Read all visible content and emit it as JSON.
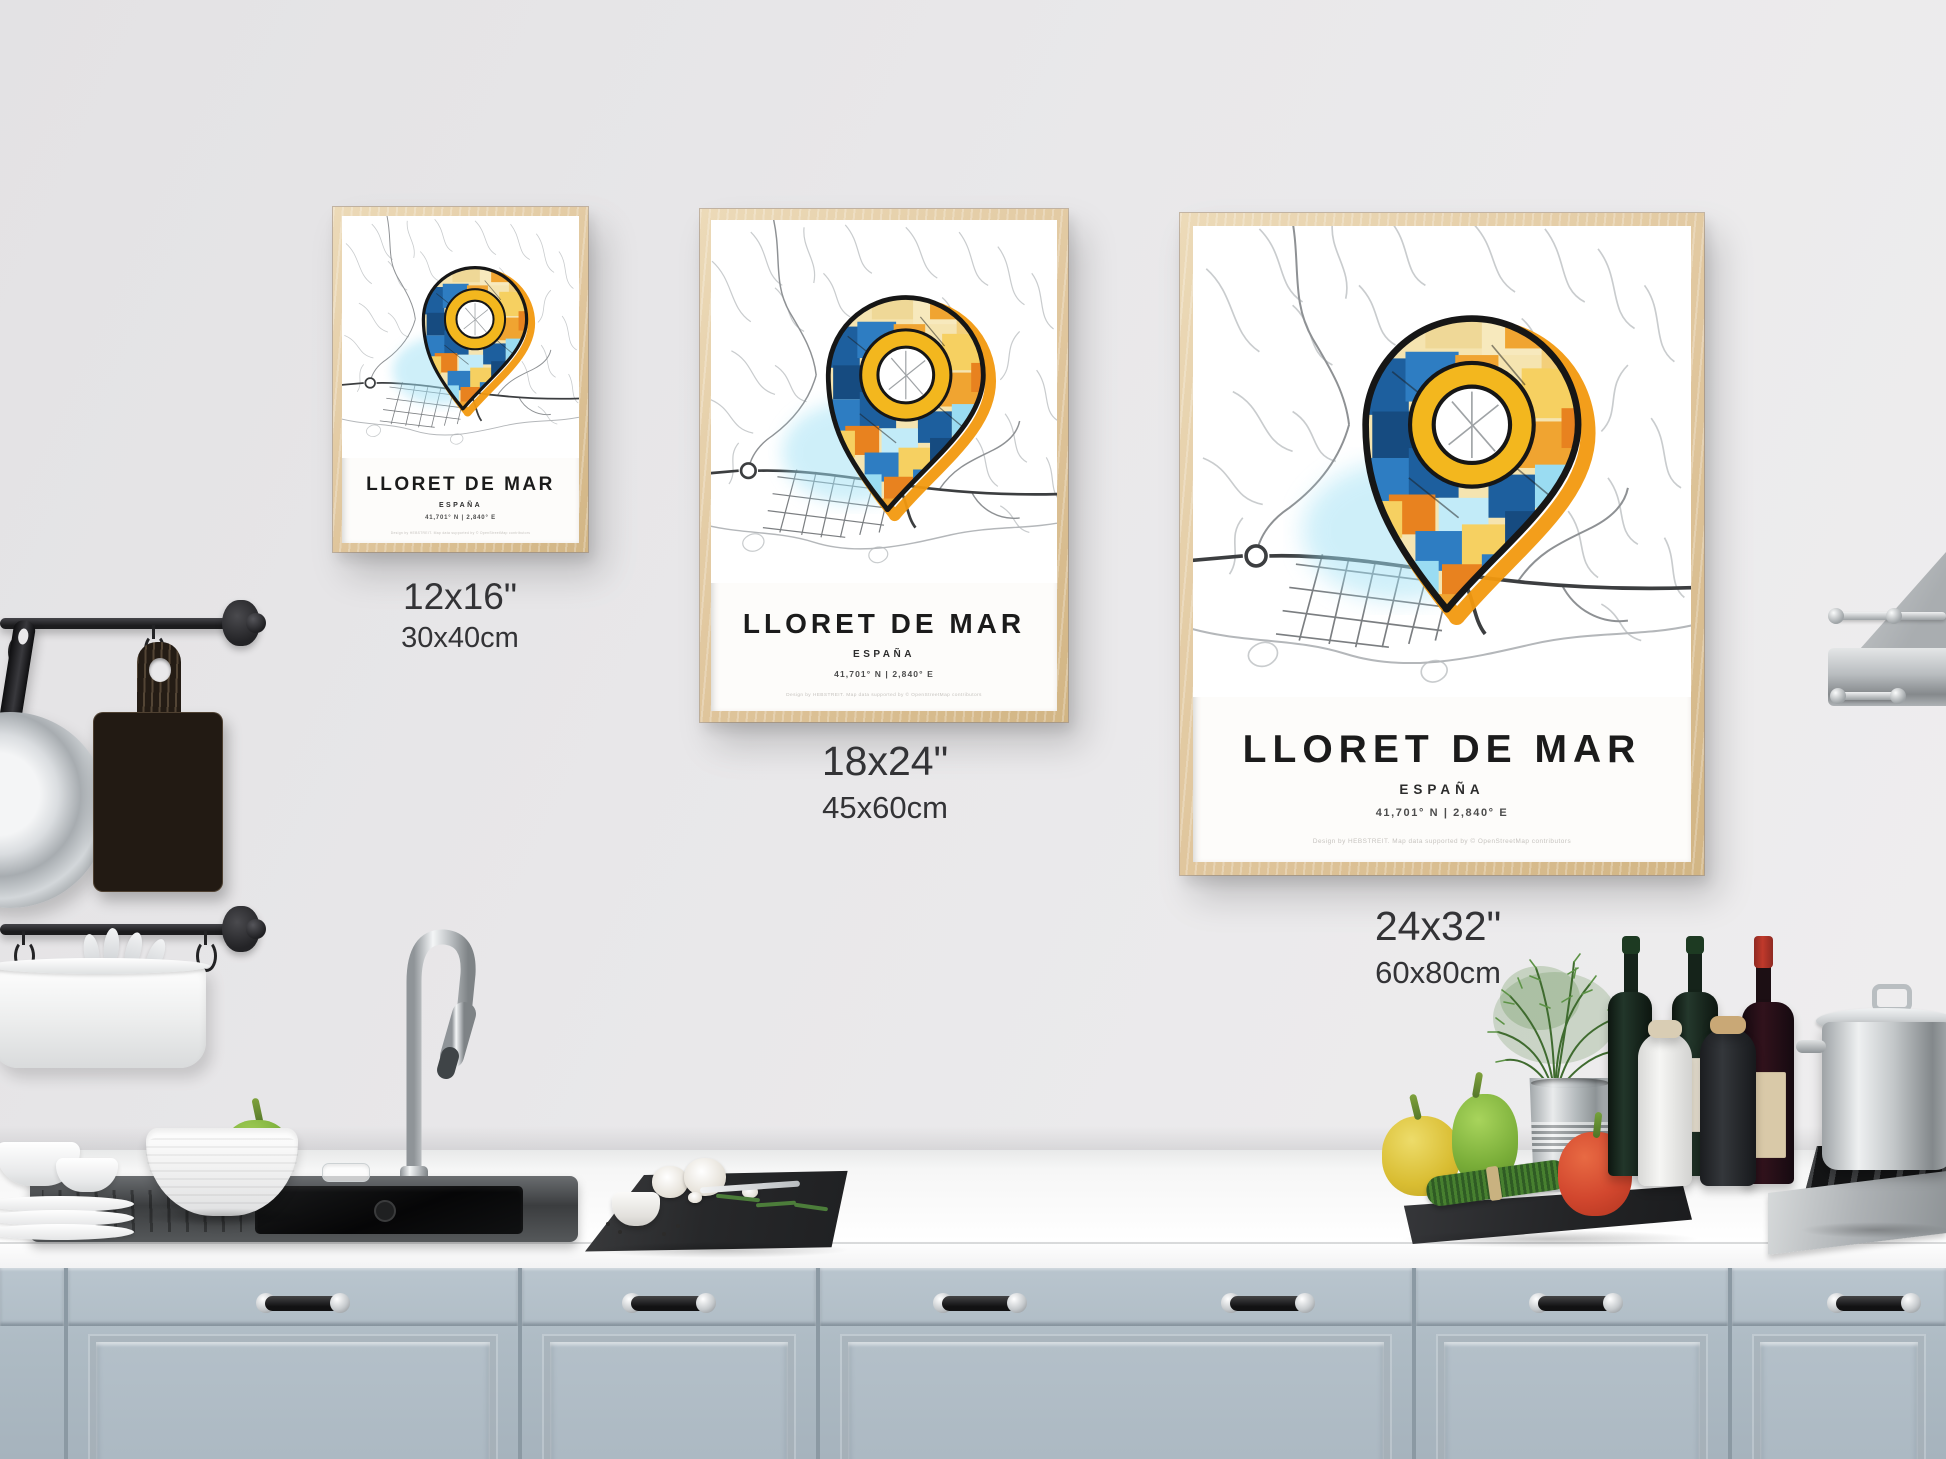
{
  "scene": {
    "description": "Kitchen wall mockup with three framed city map posters in three sizes above a kitchen counter"
  },
  "poster": {
    "title": "LLORET DE MAR",
    "country": "ESPAÑA",
    "coordinates": "41,701° N | 2,840° E",
    "credit": "Design by HEBSTREIT. Map data supported by © OpenStreetMap contributors"
  },
  "size_labels": [
    {
      "inches": "12x16\"",
      "cm": "30x40cm"
    },
    {
      "inches": "18x24\"",
      "cm": "45x60cm"
    },
    {
      "inches": "24x32\"",
      "cm": "60x80cm"
    }
  ],
  "colors": {
    "wall": "#e9e8ea",
    "frame_wood": "#e0c69d",
    "paper": "#fdfcfa",
    "cabinet_blue_gray": "#aebbc4",
    "counter_white": "#fbfbfb",
    "map_street_gray": "#9b9ea2",
    "pin_deep_blue": "#1d5f9e",
    "pin_blue": "#2e7dc2",
    "pin_light_blue": "#9adcf2",
    "pin_orange": "#e8821f",
    "pin_amber": "#f0a431",
    "pin_yellow": "#f6d061",
    "pin_cream": "#f5e4b0",
    "pin_ring_yellow": "#f3b71e",
    "pin_outline_black": "#161616",
    "pin_halo_orange": "#f2990f",
    "pin_glow_cyan": "#9fe0f4"
  }
}
